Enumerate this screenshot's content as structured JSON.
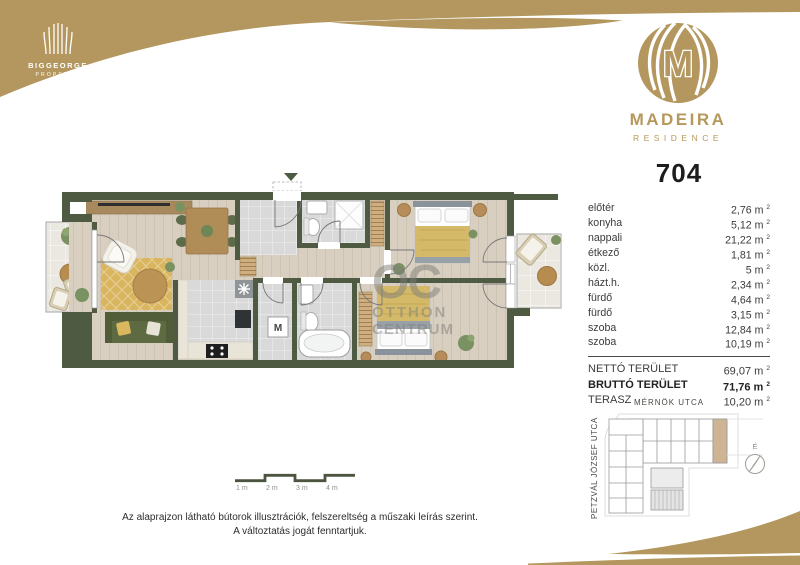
{
  "brand": {
    "developer_name": "BIGGEORGE",
    "developer_sub": "PROPERTY",
    "residence_name": "MADEIRA",
    "residence_sub": "RESIDENCE"
  },
  "unit": {
    "number": "704"
  },
  "area_unit": {
    "symbol": "m",
    "sup": "2"
  },
  "rooms": [
    {
      "label": "előtér",
      "value": "2,76"
    },
    {
      "label": "konyha",
      "value": "5,12"
    },
    {
      "label": "nappali",
      "value": "21,22"
    },
    {
      "label": "étkező",
      "value": "1,81"
    },
    {
      "label": "közl.",
      "value": "5"
    },
    {
      "label": "házt.h.",
      "value": "2,34"
    },
    {
      "label": "fürdő",
      "value": "4,64"
    },
    {
      "label": "fürdő",
      "value": "3,15"
    },
    {
      "label": "szoba",
      "value": "12,84"
    },
    {
      "label": "szoba",
      "value": "10,19"
    }
  ],
  "totals": [
    {
      "label": "NETTÓ TERÜLET",
      "value": "69,07",
      "bold": false
    },
    {
      "label": "BRUTTÓ TERÜLET",
      "value": "71,76",
      "bold": true
    },
    {
      "label": "TERASZ",
      "value": "10,20",
      "bold": false
    }
  ],
  "floorplan": {
    "washer_label": "M",
    "watermark_line1": "OC",
    "watermark_line2": "OTTHON",
    "watermark_line3": "CENTRUM"
  },
  "scalebar": {
    "labels": [
      "1 m",
      "2 m",
      "3 m",
      "4 m"
    ]
  },
  "keyplan": {
    "street_top": "MÉRNÖK UTCA",
    "street_left": "PETZVÁL JÓZSEF UTCA",
    "compass_label": "É"
  },
  "disclaimer": {
    "line1": "Az alaprajzon látható bútorok illusztrációk, felszereltség a műszaki leírás szerint.",
    "line2": "A változtatás jogát fenntartjuk."
  },
  "colors": {
    "gold": "#b3975e",
    "wall": "#4e5a42",
    "highlight": "#cdb593"
  }
}
